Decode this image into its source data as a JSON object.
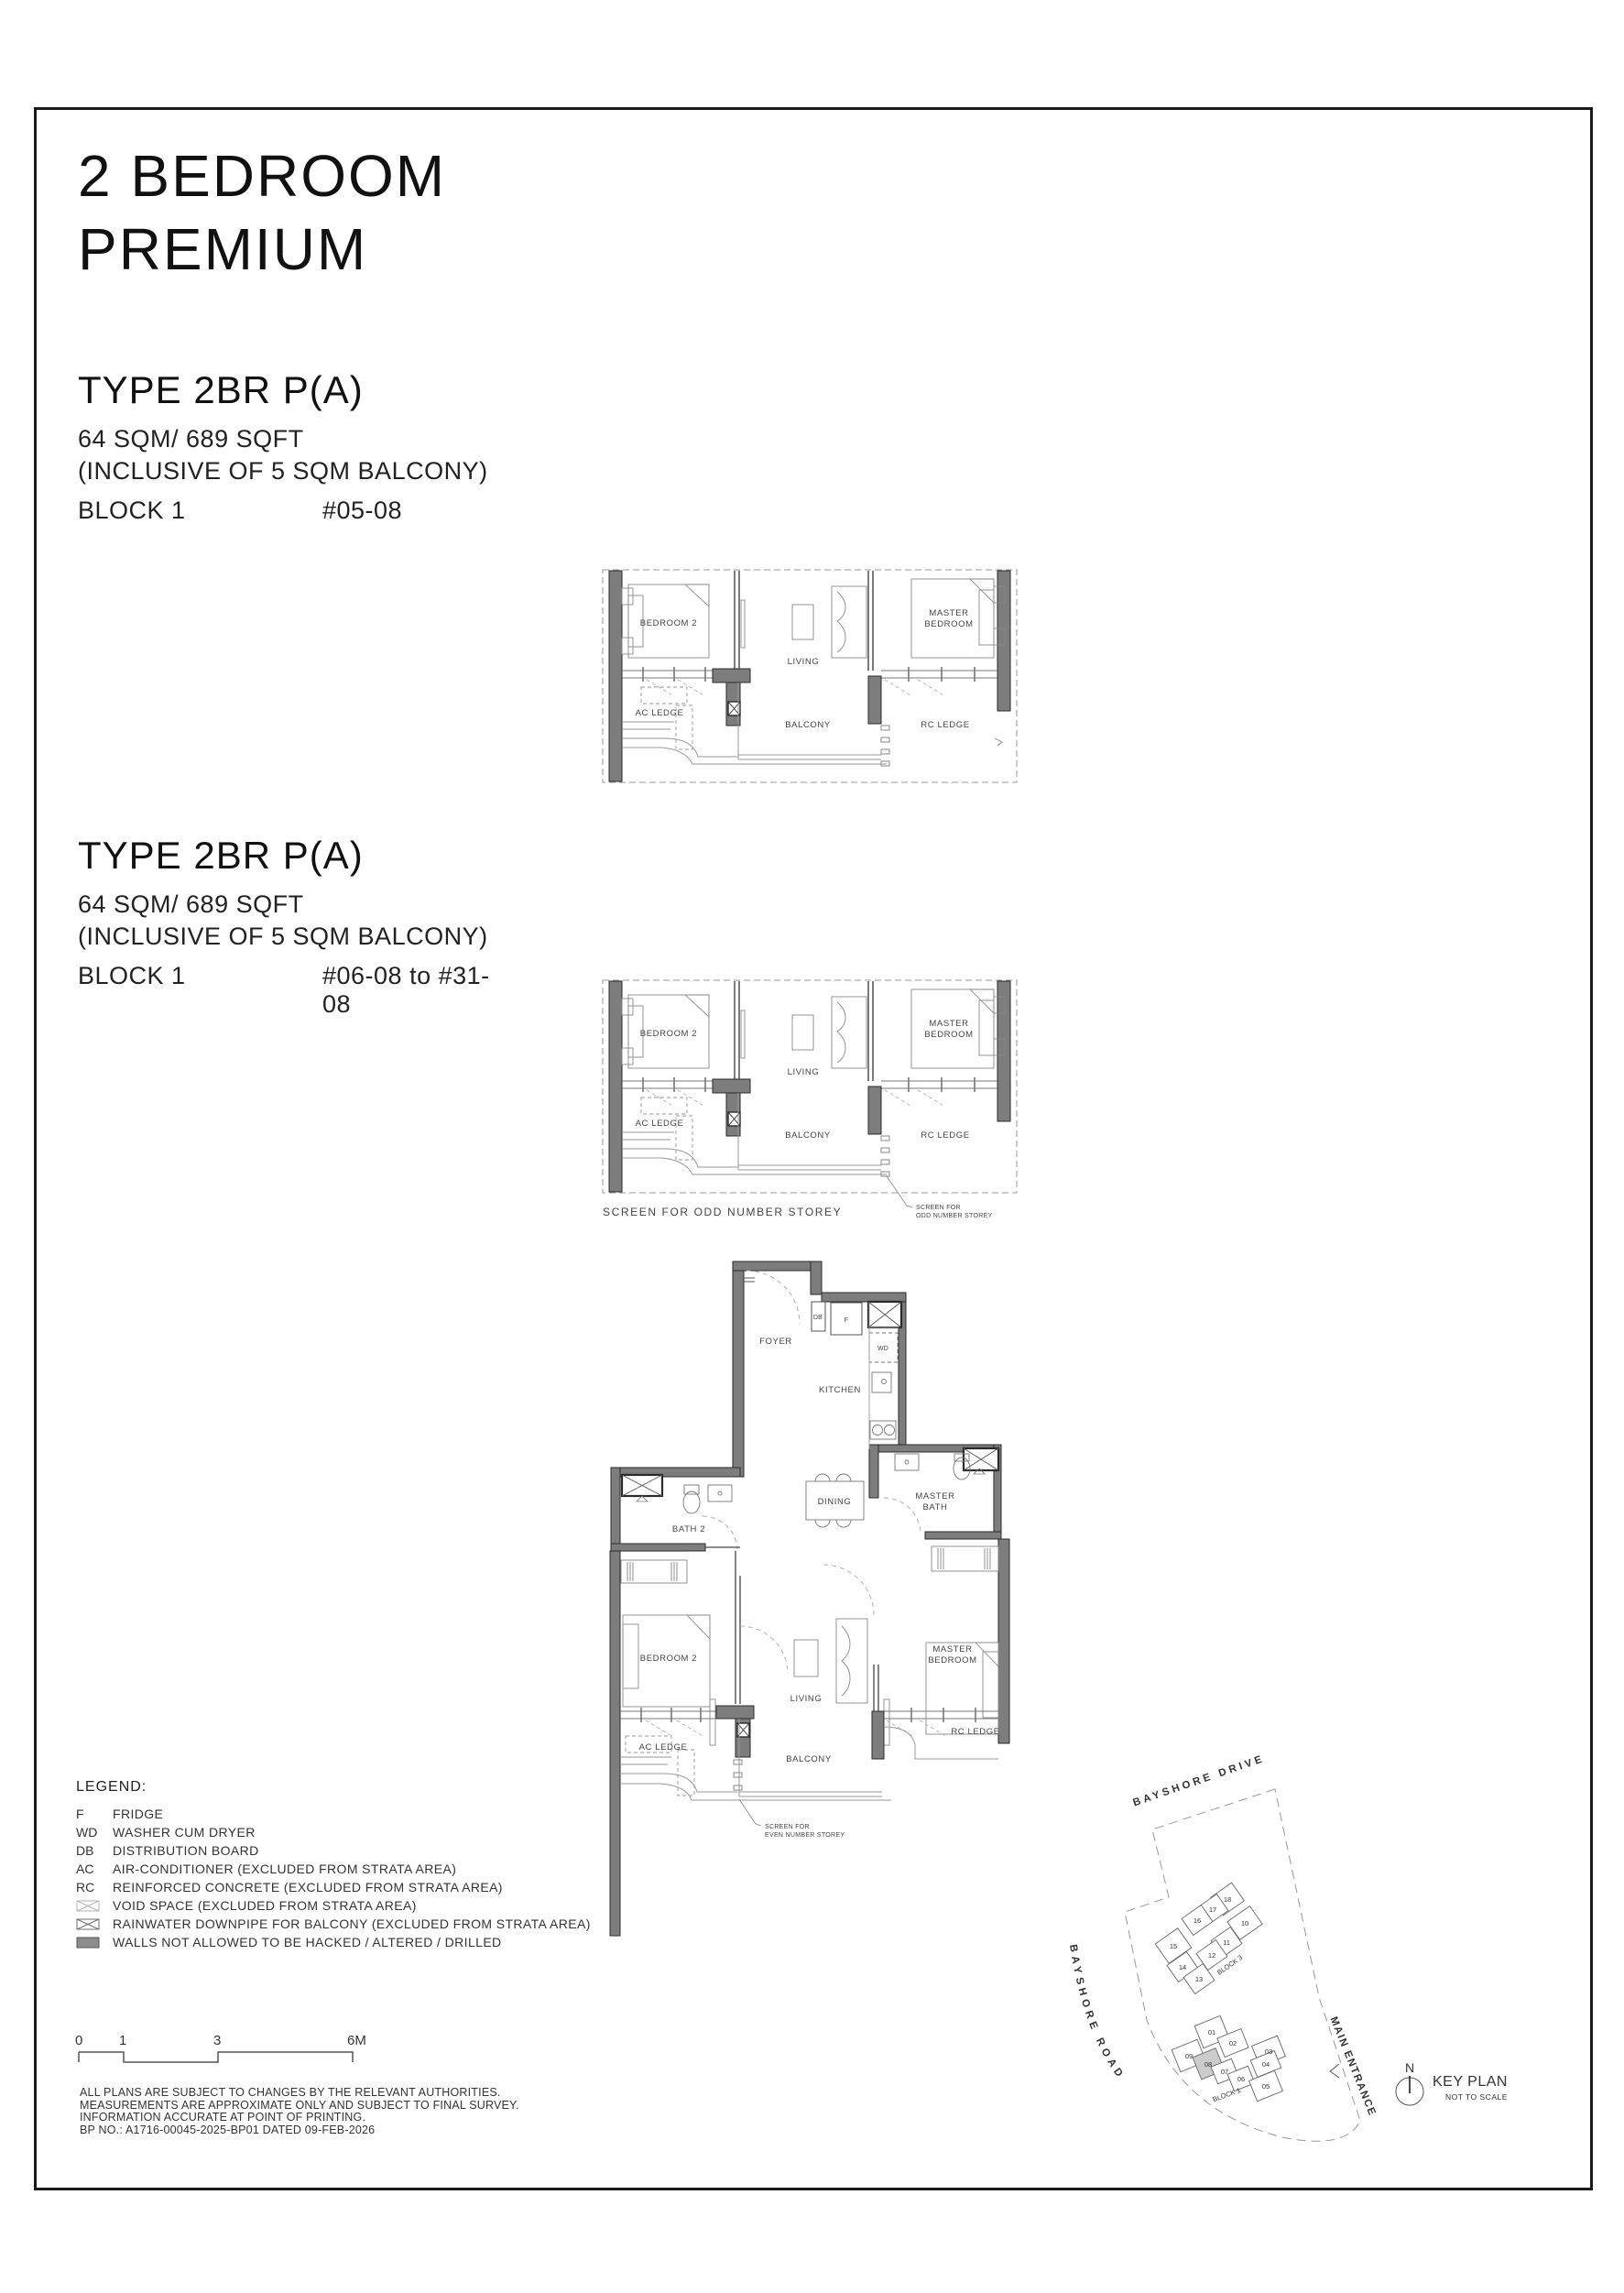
{
  "page": {
    "title_line1": "2 BEDROOM",
    "title_line2": "PREMIUM"
  },
  "type1": {
    "heading": "TYPE 2BR P(A)",
    "area": "64 SQM/ 689 SQFT",
    "area_note": "(INCLUSIVE OF 5 SQM BALCONY)",
    "block": "BLOCK 1",
    "units": "#05-08"
  },
  "type2": {
    "heading": "TYPE 2BR P(A)",
    "area": "64 SQM/ 689 SQFT",
    "area_note": "(INCLUSIVE OF 5 SQM BALCONY)",
    "block": "BLOCK 1",
    "units": "#06-08 to #31-08"
  },
  "plan_labels": {
    "bedroom2": "BEDROOM 2",
    "living": "LIVING",
    "master_bedroom_line1": "MASTER",
    "master_bedroom_line2": "BEDROOM",
    "ac_ledge": "AC LEDGE",
    "balcony": "BALCONY",
    "rc_ledge": "RC LEDGE",
    "foyer": "FOYER",
    "kitchen": "KITCHEN",
    "dining": "DINING",
    "bath2": "BATH 2",
    "master_bath_line1": "MASTER",
    "master_bath_line2": "BATH",
    "db": "DB",
    "f": "F",
    "wd": "WD"
  },
  "annotations": {
    "screen_odd_caption": "SCREEN FOR ODD NUMBER STOREY",
    "screen_odd_note_line1": "SCREEN FOR",
    "screen_odd_note_line2": "ODD NUMBER STOREY",
    "screen_even_note_line1": "SCREEN FOR",
    "screen_even_note_line2": "EVEN NUMBER STOREY"
  },
  "legend": {
    "heading": "LEGEND:",
    "items": [
      {
        "abbr": "F",
        "desc": "FRIDGE"
      },
      {
        "abbr": "WD",
        "desc": "WASHER CUM DRYER"
      },
      {
        "abbr": "DB",
        "desc": "DISTRIBUTION BOARD"
      },
      {
        "abbr": "AC",
        "desc": "AIR-CONDITIONER (EXCLUDED FROM STRATA AREA)"
      },
      {
        "abbr": "RC",
        "desc": "REINFORCED CONCRETE (EXCLUDED FROM STRATA AREA)"
      },
      {
        "symbol": "void-space",
        "desc": "VOID SPACE (EXCLUDED FROM STRATA AREA)"
      },
      {
        "symbol": "rainwater-downpipe",
        "desc": "RAINWATER DOWNPIPE FOR BALCONY (EXCLUDED FROM STRATA AREA)"
      },
      {
        "symbol": "hatched-wall",
        "desc": "WALLS NOT ALLOWED TO BE HACKED / ALTERED / DRILLED"
      }
    ]
  },
  "scale_bar": {
    "t0": "0",
    "t1": "1",
    "t3": "3",
    "t6": "6M"
  },
  "disclaimer": {
    "line1": "ALL PLANS ARE SUBJECT TO CHANGES BY THE RELEVANT AUTHORITIES.",
    "line2": "MEASUREMENTS ARE APPROXIMATE ONLY AND SUBJECT TO FINAL SURVEY.",
    "line3": "INFORMATION ACCURATE AT POINT OF PRINTING.",
    "line4": "BP NO.: A1716-00045-2025-BP01 DATED 09-FEB-2026"
  },
  "keyplan": {
    "road_top": "BAYSHORE DRIVE",
    "road_left": "BAYSHORE ROAD",
    "main_entrance": "MAIN ENTRANCE",
    "block3_label": "BLOCK 3",
    "block1_label": "BLOCK 1",
    "north": "N",
    "title": "KEY PLAN",
    "subtitle": "NOT TO SCALE",
    "b3u0": "18",
    "b3u1": "17",
    "b3u2": "16",
    "b3u3": "10",
    "b3u4": "11",
    "b3u5": "12",
    "b3u6": "15",
    "b3u7": "14",
    "b3u8": "13",
    "b1u0": "01",
    "b1u1": "02",
    "b1u2": "03",
    "b1u3": "04",
    "b1u4": "09",
    "b1u5": "08",
    "b1u6": "07",
    "b1u7": "06",
    "b1u8": "05",
    "highlighted_unit": "08"
  },
  "colors": {
    "wall": "#7d7d7d",
    "line": "#2a2a2a",
    "highlight": "#cccccc"
  }
}
